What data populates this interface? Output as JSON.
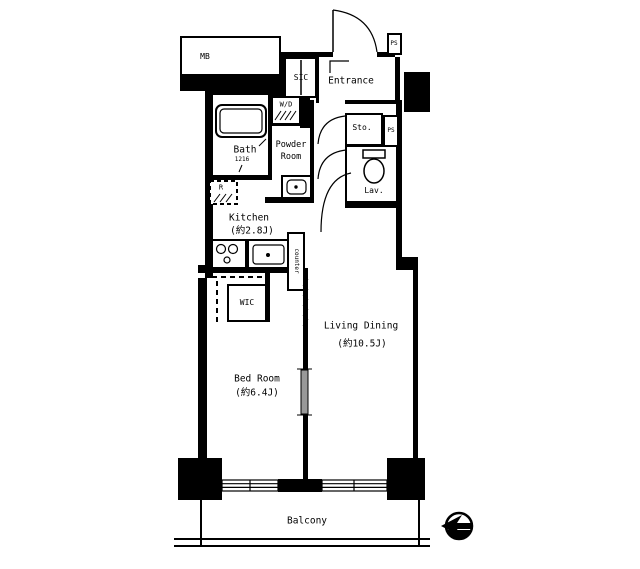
{
  "plan": {
    "rooms": {
      "mb": {
        "name": "MB"
      },
      "sic": {
        "name": "SIC"
      },
      "entrance": {
        "name": "Entrance"
      },
      "ps_top": {
        "name": "PS"
      },
      "wd": {
        "name": "W/D"
      },
      "bath": {
        "name": "Bath",
        "size": "1216"
      },
      "powder": {
        "line1": "Powder",
        "line2": "Room"
      },
      "sto": {
        "name": "Sto."
      },
      "ps_mid": {
        "name": "PS"
      },
      "lav": {
        "name": "Lav."
      },
      "fridge": {
        "name": "R"
      },
      "kitchen": {
        "name": "Kitchen",
        "size": "(約2.8J)"
      },
      "counter": {
        "name": "counter"
      },
      "wic": {
        "name": "WIC"
      },
      "bedroom": {
        "name": "Bed Room",
        "size": "(約6.4J)"
      },
      "living": {
        "name": "Living Dining",
        "size": "(約10.5J)"
      },
      "balcony": {
        "name": "Balcony"
      }
    },
    "colors": {
      "wall": "#000000",
      "background": "#ffffff",
      "glass_door": "#999999"
    },
    "compass": {
      "icon": "north-arrow",
      "points": "left"
    }
  }
}
